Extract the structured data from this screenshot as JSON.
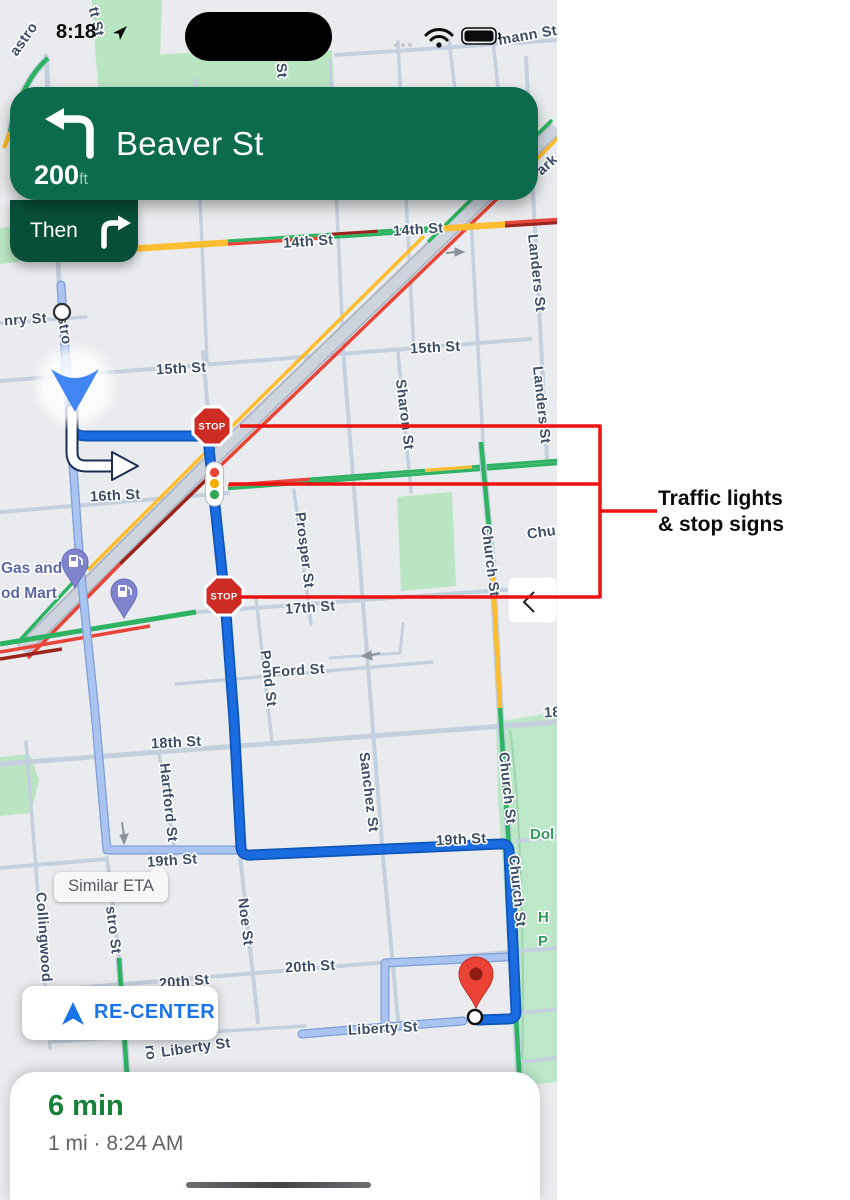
{
  "status_bar": {
    "time": "8:18"
  },
  "banner": {
    "street": "Beaver St",
    "distance": "200",
    "unit": "ft",
    "then": "Then"
  },
  "map": {
    "stop_sign": "STOP",
    "eta_bubble": "Similar ETA",
    "recenter": "RE-CENTER",
    "streets": [
      "astro",
      "tt St",
      "mann St",
      "14th St",
      "14th St",
      "nry St",
      "15th St",
      "15th St",
      "stro",
      "16th St",
      "17th St",
      "Ford St",
      "18th St",
      "19th St",
      "19th St",
      "20th St",
      "20th St",
      "Liberty St",
      "Liberty St",
      "Sharon St",
      "Landers St",
      "Landers St",
      "Pond St",
      "Prosper St",
      "Sanchez St",
      "Hartford St",
      "Noe St",
      "Church St",
      "Church St",
      "Church St",
      "Collingwood",
      "stro St",
      "ro",
      "Chu",
      "18",
      "St",
      "ark"
    ],
    "pois": {
      "gas1": "Gas and",
      "gas2": "od Mart",
      "park": "Dol",
      "park_h": "H",
      "park_p": "P"
    }
  },
  "sheet": {
    "eta": "6 min",
    "details": "1 mi · 8:24 AM"
  },
  "annotation": {
    "line1": "Traffic lights",
    "line2": "& stop signs"
  },
  "colors": {
    "annotation_red": "#ee1111",
    "route_blue": "#1a6ce0",
    "alt_route": "#aac4f2",
    "banner_green": "#0c6a4d",
    "then_green": "#084f3a",
    "eta_green": "#188038",
    "google_blue": "#1a73e8",
    "traffic_green": "#2eb362",
    "traffic_yellow": "#fdbd2d",
    "traffic_red": "#e8443a",
    "traffic_darkred": "#9c241c"
  }
}
